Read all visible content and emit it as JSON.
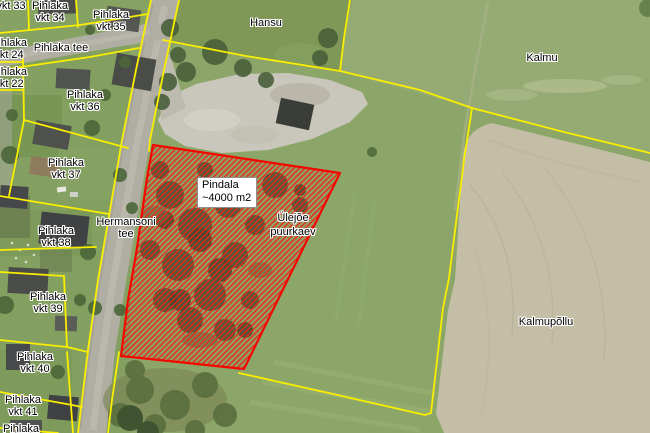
{
  "map": {
    "description_labels": "Cadastral aerial map with parcel labels",
    "selected_parcel_note": "red hatched parcel approx 4000 m2"
  },
  "labels": [
    {
      "id": "vkt-33",
      "lines": [
        "vkt 33"
      ]
    },
    {
      "id": "pihlaka-vkt-34",
      "lines": [
        "Pihlaka",
        "vkt 34"
      ]
    },
    {
      "id": "pihlaka-vkt-35",
      "lines": [
        "Pihlaka",
        "vkt 35"
      ]
    },
    {
      "id": "pihlaka-tee",
      "lines": [
        "Pihlaka tee"
      ]
    },
    {
      "id": "pihlaka-vkt-24",
      "lines": [
        "Pihlaka",
        "vkt 24"
      ]
    },
    {
      "id": "pihlaka-vkt-22",
      "lines": [
        "Pihlaka",
        "vkt 22"
      ]
    },
    {
      "id": "pihlaka-vkt-36",
      "lines": [
        "Pihlaka",
        "vkt 36"
      ]
    },
    {
      "id": "pihlaka-vkt-37",
      "lines": [
        "Pihlaka",
        "vkt 37"
      ]
    },
    {
      "id": "hermansoni-tee",
      "lines": [
        "Hermansoni",
        "tee"
      ]
    },
    {
      "id": "pihlaka-vkt-38",
      "lines": [
        "Pihlaka",
        "vkt 38"
      ]
    },
    {
      "id": "pihlaka-vkt-39",
      "lines": [
        "Pihlaka",
        "vkt 39"
      ]
    },
    {
      "id": "pihlaka-vkt-40",
      "lines": [
        "Pihlaka",
        "vkt 40"
      ]
    },
    {
      "id": "pihlaka-vkt-41",
      "lines": [
        "Pihlaka",
        "vkt 41"
      ]
    },
    {
      "id": "pihlaka-42",
      "lines": [
        "Pihlaka"
      ]
    },
    {
      "id": "hansu",
      "lines": [
        "Hansu"
      ]
    },
    {
      "id": "kalmu",
      "lines": [
        "Kalmu"
      ]
    },
    {
      "id": "kalmupollu",
      "lines": [
        "Kalmupõllu"
      ]
    },
    {
      "id": "ulejoe-puurkaev",
      "lines": [
        "Ülejõe",
        "puurkaev"
      ]
    }
  ],
  "area_box": {
    "line1": "Pindala",
    "line2": "~4000 m2"
  },
  "colors": {
    "boundary_yellow": "#f9ee00",
    "selection_red": "#ee2413",
    "pasture_green": "#8ca66a",
    "field_tan": "#c4bea7",
    "road_gray": "#b0aea3",
    "label_text": "#000000",
    "label_halo": "#ffffff"
  }
}
